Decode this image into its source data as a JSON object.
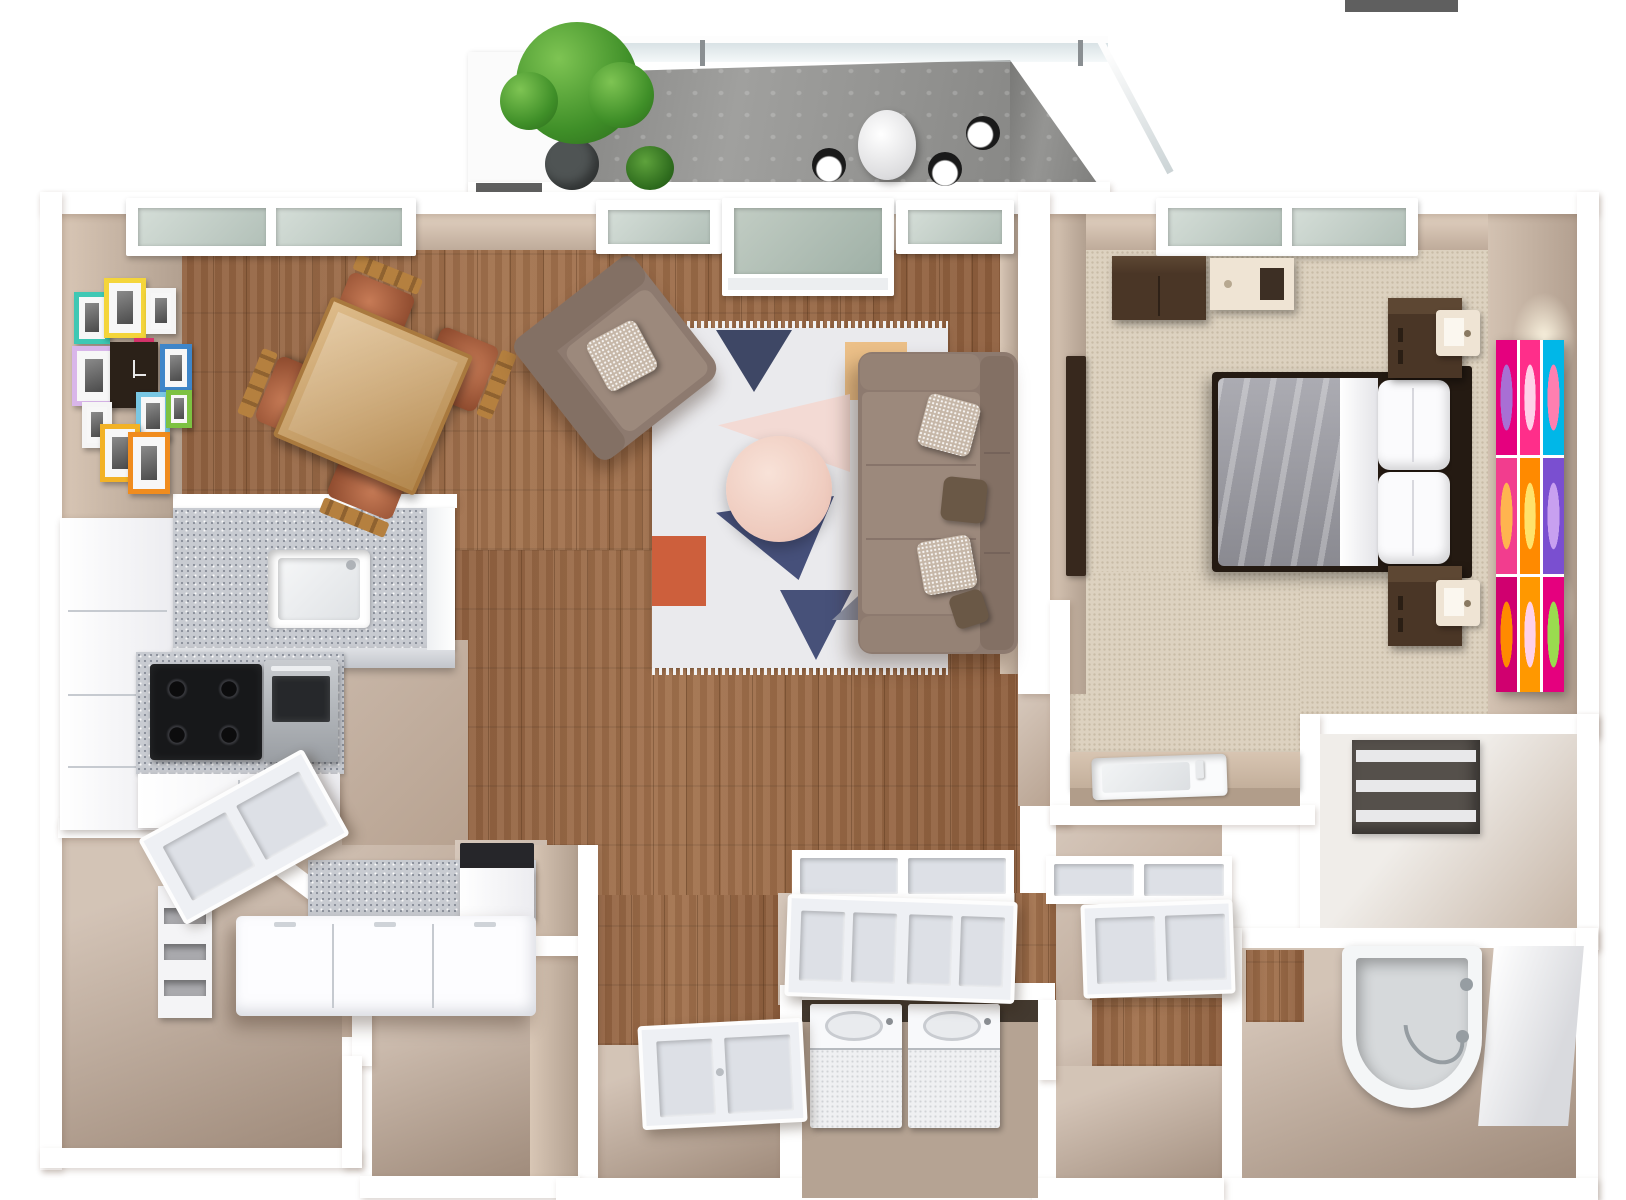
{
  "scene": {
    "title": "One-bedroom apartment 3D floor plan rendering",
    "view": "top-down 3D dollhouse view",
    "canvas": {
      "width": 1626,
      "height": 1200
    },
    "rooms": [
      {
        "id": "balcony",
        "label": "Balcony",
        "floor": "concrete"
      },
      {
        "id": "living-room",
        "label": "Living Room",
        "floor": "hardwood"
      },
      {
        "id": "dining-area",
        "label": "Dining Area",
        "floor": "hardwood"
      },
      {
        "id": "kitchen",
        "label": "Kitchen",
        "floor": "hardwood"
      },
      {
        "id": "pantry",
        "label": "Pantry Corridor",
        "floor": "tile"
      },
      {
        "id": "storage-room",
        "label": "Storage Room",
        "floor": "tile"
      },
      {
        "id": "entry-hall",
        "label": "Entry Hall",
        "floor": "hardwood"
      },
      {
        "id": "hallway",
        "label": "Hallway with Closets",
        "floor": "hardwood"
      },
      {
        "id": "laundry-closet",
        "label": "Laundry Closet",
        "floor": "tile"
      },
      {
        "id": "bedroom",
        "label": "Bedroom",
        "floor": "carpet"
      },
      {
        "id": "bedroom-vanity",
        "label": "Bedroom Vanity",
        "floor": "carpet"
      },
      {
        "id": "linen-closet",
        "label": "Linen Closet",
        "floor": "tile"
      },
      {
        "id": "bathroom",
        "label": "Bathroom",
        "floor": "tile"
      }
    ]
  },
  "palette": {
    "background": "#ffffff",
    "wall": "#ffffff",
    "wallface": "#c9b6a5",
    "wood": "#9a6a48",
    "tan": "#c7b3a2",
    "tanDark": "#b5a290",
    "carpet": "#ddd2c0",
    "concrete": "#9b9b99",
    "concreteDark": "#8d8d8b",
    "granite": "#c8cbd1",
    "glass": "#c3cfc9",
    "ledge": "#5f5f5f",
    "planter": "#fbfbfb",
    "pot": "#4f5454",
    "bistroBlack": "#1a1a1a",
    "sofa": "#8d7a6f",
    "sofaBack": "#837064",
    "sofaArm": "#958275",
    "cushion": "#9c897c",
    "pillowSparkle": "#c6b7a8",
    "pillowBrown": "#6a5846",
    "coffeeTable": "#f2d0c2",
    "diningWood": "#c79b5f",
    "chairWood": "#b5803f",
    "chairLeather": "#a8512e",
    "stove": "#17181a",
    "steel": "#aeb2b7",
    "islandWhite": "#fdfdff",
    "applianceDark": "#26262a",
    "walnut": "#4a3626",
    "walnutDark": "#37281d",
    "headboard": "#241a12",
    "duvet": "#9d9da5",
    "linen": "#fbfbfd",
    "lampCream": "#efe4d4",
    "tub": "#f4f6f7",
    "tubBasin": "#d6d9db",
    "chrome": "#969da2",
    "shelfDark": "#55504b",
    "shelfBoard": "#e8e8ea",
    "closetInterior": "#b5a393",
    "closetShadow": "#43392f"
  },
  "rug": {
    "base": "#eaeaed",
    "fringe": "#f2f2f2",
    "navy": "#3e4765",
    "navy2": "#46507a",
    "navy3": "#475179",
    "peach": "#ecc088",
    "blush": "#f3dad4",
    "khaki": "#d5bb7d",
    "orange": "#cd5f3c",
    "gray": "#8d93a6"
  },
  "frames": {
    "items": [
      "#3fc8b4",
      "#f4d53a",
      "#f5f5f5",
      "#d9b6ea",
      "#d6336c",
      "#3f86c9",
      "#79c7e3",
      "#f5f5f5",
      "#f2b226",
      "#f08c1e",
      "#7dc242"
    ],
    "clock": "#2b2118"
  },
  "art": {
    "rows": 3,
    "cols": 3,
    "cells": [
      {
        "outer": "#e5007e",
        "inner": "#a86fd4"
      },
      {
        "outer": "#ff2e8a",
        "inner": "#ffd1e8"
      },
      {
        "outer": "#00b7e8",
        "inner": "#ff7fb0"
      },
      {
        "outer": "#f23d8e",
        "inner": "#ffb44f"
      },
      {
        "outer": "#ff8a00",
        "inner": "#ffe26b"
      },
      {
        "outer": "#7a4fd0",
        "inner": "#c8a0f0"
      },
      {
        "outer": "#d0006f",
        "inner": "#ff8a00"
      },
      {
        "outer": "#ff9800",
        "inner": "#ffd1e8"
      },
      {
        "outer": "#e5007e",
        "inner": "#9adb4f"
      }
    ]
  },
  "fixtures": {
    "windows": [
      "dining-double-window",
      "living-left-window",
      "balcony-patio-door",
      "living-right-window",
      "bedroom-double-window"
    ],
    "doors": [
      "kitchen-door",
      "entry-door",
      "left-closet-double-door",
      "right-closet-double-door"
    ],
    "kitchen": [
      "refrigerator-cabinet",
      "undermount-sink",
      "four-burner-cooktop",
      "wall-oven",
      "dishwasher",
      "island-with-drawers",
      "pantry-shelves"
    ],
    "laundry": [
      "top-load-washer",
      "top-load-dryer"
    ],
    "bathroom": [
      "bathtub",
      "grab-bar",
      "tub-faucet"
    ],
    "bedroom": [
      "double-bed",
      "headboard",
      "nightstand-x2",
      "cube-lamp-x2",
      "dresser",
      "media-panel",
      "pop-art-canvas",
      "vanity-sink"
    ],
    "balcony": [
      "potted-tree",
      "shrub",
      "bistro-table",
      "bistro-chair-x3",
      "glass-railing"
    ]
  }
}
